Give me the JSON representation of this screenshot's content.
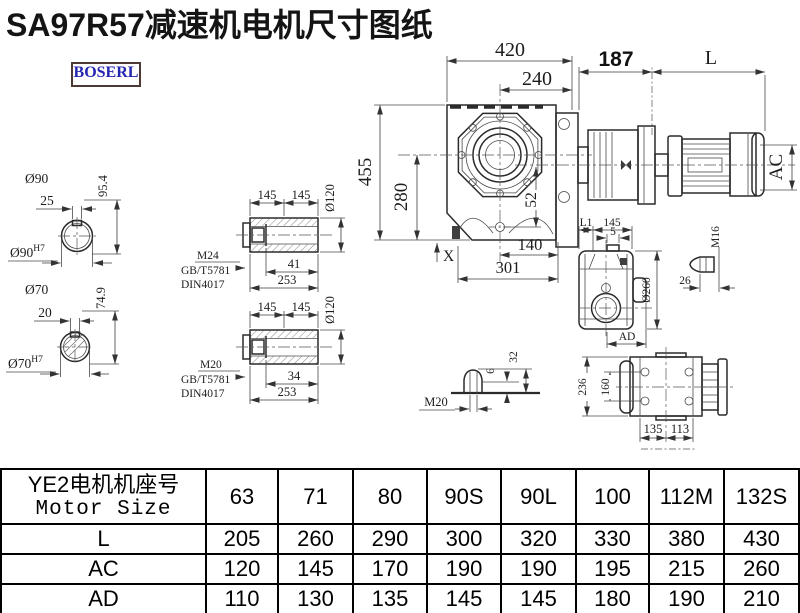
{
  "title": "SA97R57减速机电机尺寸图纸",
  "logo": "BOSERL",
  "main_view": {
    "top_width": "420",
    "inner_width": "240",
    "height": "455",
    "center_height": "280",
    "hole_offset": "52",
    "x_label": "X",
    "base_inner": "140",
    "base_total": "301"
  },
  "motor": {
    "flange_len": "187",
    "len": "L",
    "width": "AC"
  },
  "shaft1": {
    "dia": "Ø90",
    "key": "25",
    "height": "95.4",
    "fit": "Ø90",
    "fit_sup": "H7"
  },
  "shaft2": {
    "dia": "Ø70",
    "key": "20",
    "height": "74.9",
    "fit": "Ø70",
    "fit_sup": "H7"
  },
  "hollow1": {
    "seg1": "145",
    "seg2": "145",
    "dia": "Ø120",
    "bolt": "M24",
    "std1": "GB/T5781",
    "std2": "DIN4017",
    "depth": "41",
    "total": "253"
  },
  "hollow2": {
    "seg1": "145",
    "seg2": "145",
    "dia": "Ø120",
    "bolt": "M20",
    "std1": "GB/T5781",
    "std2": "DIN4017",
    "depth": "34",
    "total": "253"
  },
  "front_view": {
    "l1": "L1",
    "seg": "145",
    "key": "5",
    "dia": "Ø260",
    "ad": "AD"
  },
  "plug": {
    "thread": "M16",
    "len": "26"
  },
  "vent": {
    "thread": "M20",
    "h_small": "6",
    "h_big": "32"
  },
  "rear_view": {
    "height": "236",
    "span": "160",
    "left": "135",
    "right": "113"
  },
  "table": {
    "header_cn": "YE2电机机座号",
    "header_en": "Motor Size",
    "columns": [
      "63",
      "71",
      "80",
      "90S",
      "90L",
      "100",
      "112M",
      "132S"
    ],
    "rows": [
      {
        "label": "L",
        "values": [
          "205",
          "260",
          "290",
          "300",
          "320",
          "330",
          "380",
          "430"
        ]
      },
      {
        "label": "AC",
        "values": [
          "120",
          "145",
          "170",
          "190",
          "190",
          "195",
          "215",
          "260"
        ]
      },
      {
        "label": "AD",
        "values": [
          "110",
          "130",
          "135",
          "145",
          "145",
          "180",
          "190",
          "210"
        ]
      }
    ]
  }
}
